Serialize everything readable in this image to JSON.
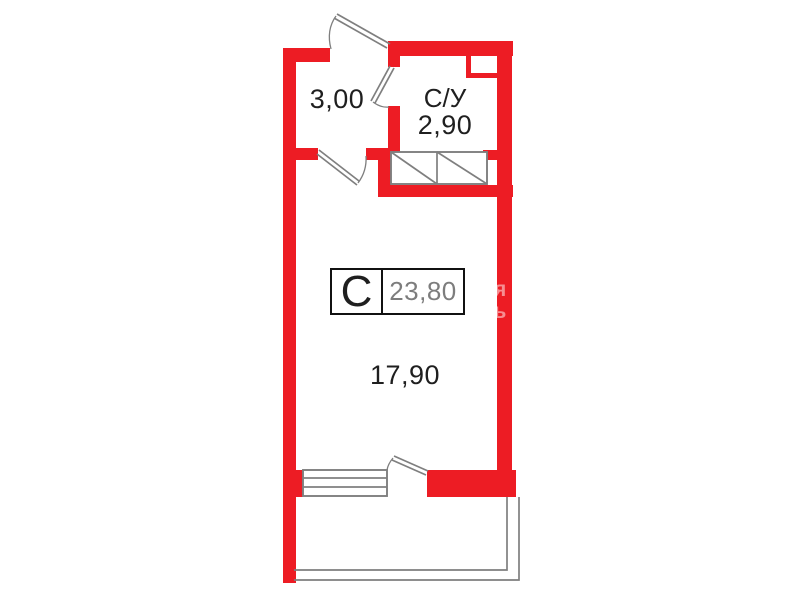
{
  "plan": {
    "unit": {
      "type_label": "С",
      "total_area": "23,80"
    },
    "rooms": {
      "hallway": {
        "area": "3,00"
      },
      "bathroom": {
        "name": "С/У",
        "area": "2,90"
      },
      "living": {
        "area": "17,90"
      }
    },
    "watermark_fragments": [
      "я",
      "ъ"
    ],
    "colors": {
      "wall": "#ed1c24",
      "outline": "#7f7f7f",
      "text": "#1f1f1f",
      "area_value": "#7d7d7d",
      "label_border": "#111111"
    }
  }
}
